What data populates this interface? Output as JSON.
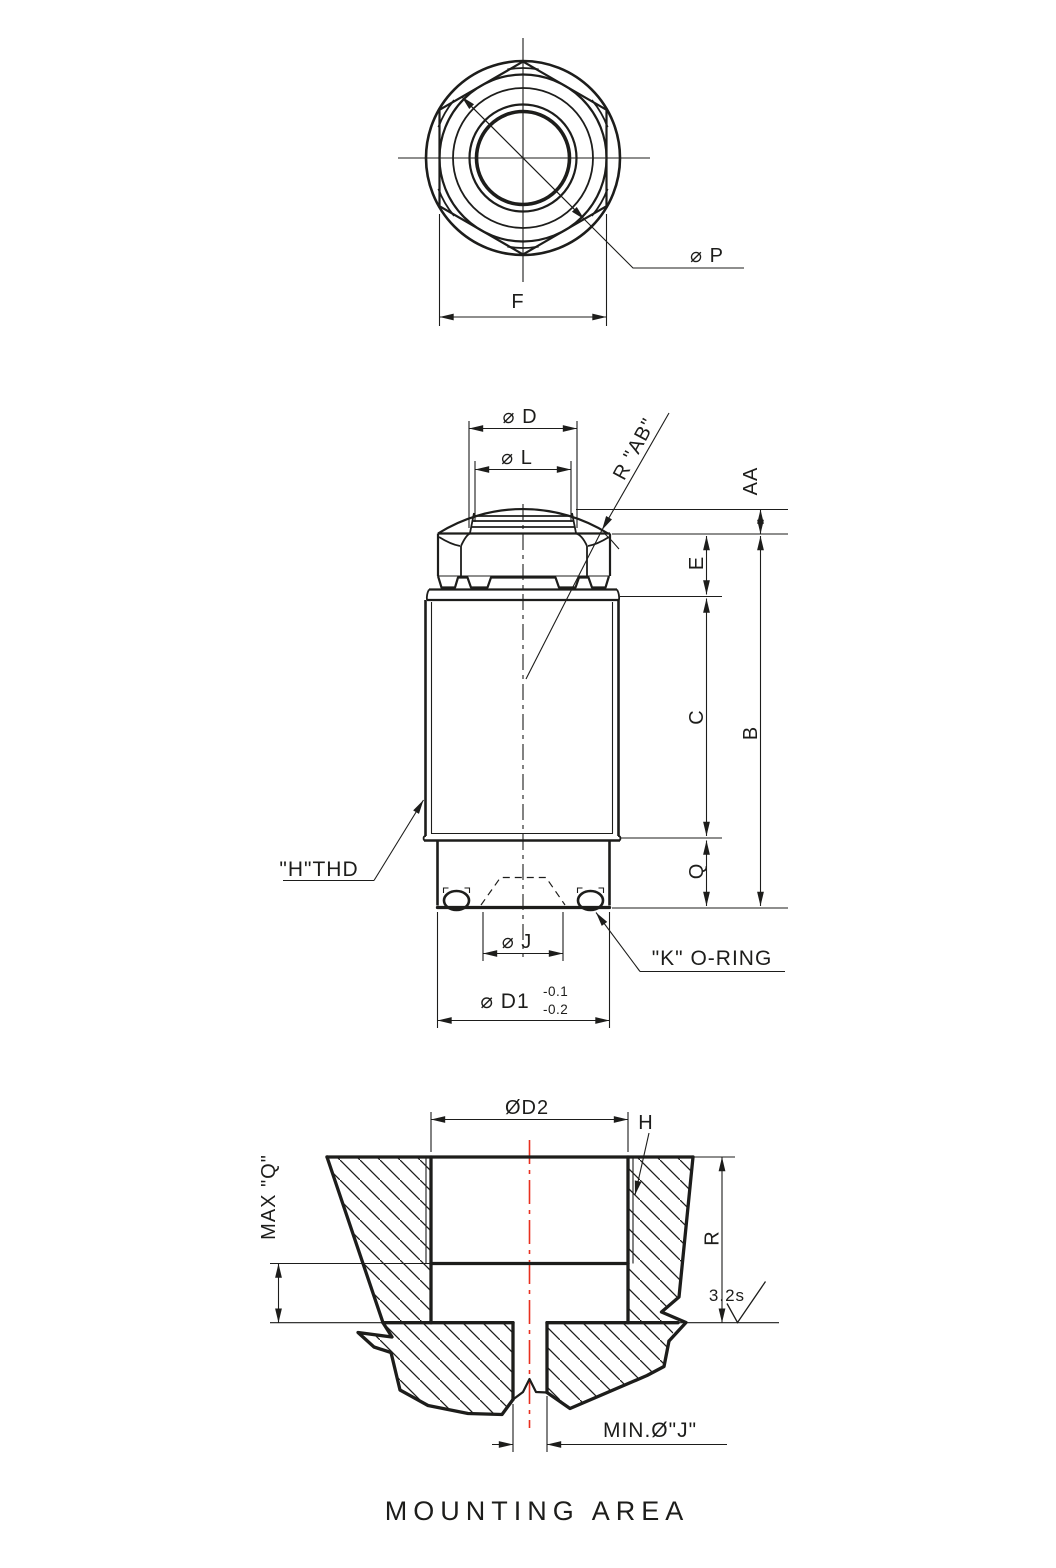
{
  "drawing": {
    "title": "MOUNTING AREA",
    "colors": {
      "line": "#1d1d1b",
      "centerline_red": "#e8301f",
      "background": "#ffffff"
    },
    "top_view": {
      "labels": {
        "p": "⌀ P",
        "f": "F"
      }
    },
    "side_view": {
      "labels": {
        "d": "⌀ D",
        "l": "⌀ L",
        "r_ab": "R \"AB\"",
        "aa": "AA",
        "e": "E",
        "c": "C",
        "b": "B",
        "q": "Q",
        "h_thd": "\"H\"THD",
        "j": "⌀ J",
        "k_oring": "\"K\" O-RING",
        "d1": "⌀ D1",
        "d1_tol_upper": "-0.1",
        "d1_tol_lower": "-0.2"
      }
    },
    "mounting_view": {
      "labels": {
        "d2": "ØD2",
        "h": "H",
        "max_q": "MAX \"Q\"",
        "r": "R",
        "surface_finish": "3.2s",
        "min_j": "MIN.Ø\"J\""
      }
    }
  }
}
